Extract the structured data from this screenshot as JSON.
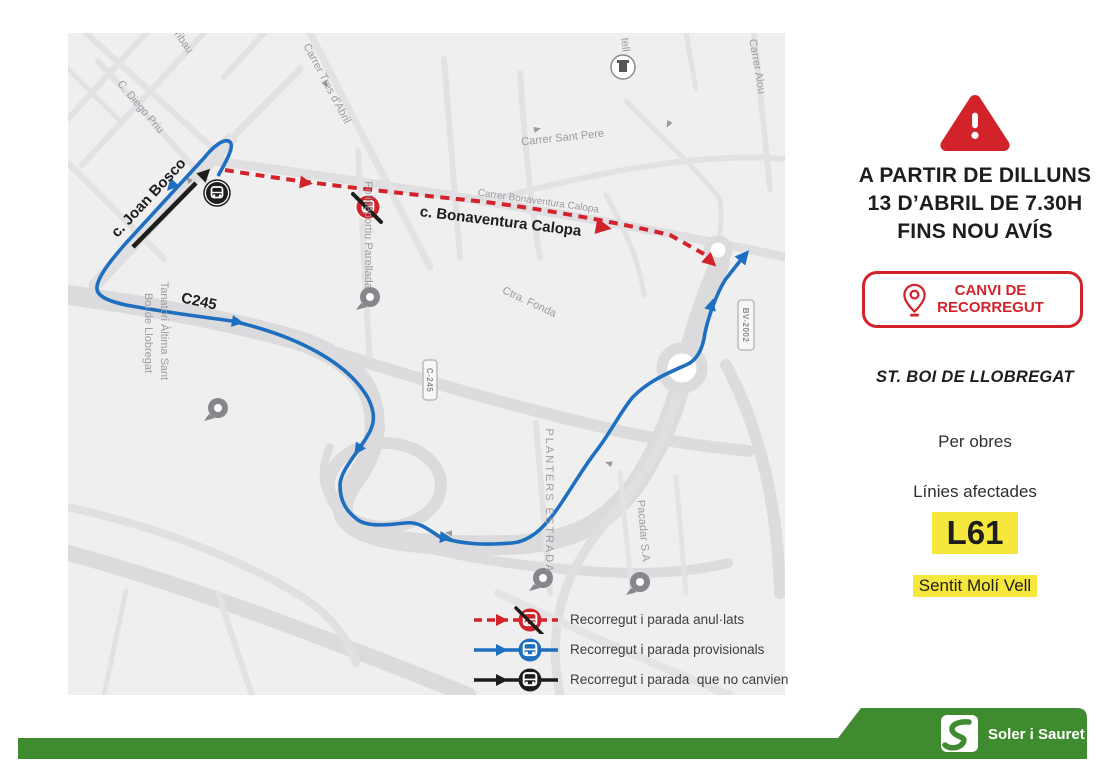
{
  "poster": {
    "alert": {
      "title_lines": [
        "A PARTIR DE DILLUNS",
        "13 D’ABRIL DE 7.30H",
        "FINS NOU AVÍS"
      ],
      "badge": {
        "line1": "CANVI DE",
        "line2": "RECORREGUT"
      },
      "location": "ST. BOI DE LLOBREGAT",
      "reason": "Per obres",
      "affected_label": "Línies afectades",
      "line_code": "L61",
      "direction": "Sentit Molí Vell"
    },
    "legend": {
      "items": [
        {
          "id": "cancelled",
          "label": "Recorregut i parada anul·lats",
          "color": "#d2232a"
        },
        {
          "id": "provisional",
          "label": "Recorregut i parada provisionals",
          "color": "#1e6fbf"
        },
        {
          "id": "unchanged",
          "label": "Recorregut i parada  que no canvien",
          "color": "#1d1d1b"
        }
      ]
    },
    "map": {
      "route_annotations": {
        "joan_bosco": "c. Joan Bosco",
        "bonaventura_calopa": "c. Bonaventura Calopa",
        "c245": "C245"
      },
      "street_labels": {
        "aribau": "ribau",
        "tres_dabril": "Carrer Tres d'Abril",
        "diego_priu": "C. Diego Priu",
        "polideportiu": "Polideportiu Parellada",
        "bonaventura_gray": "Carrer Bonaventura Calopa",
        "sant_pere": "Carrer Sant Pere",
        "castell": "tell",
        "carrer_alou": "Carrer Alou",
        "tanatori_line1": "Tanatori Àltima Sant",
        "tanatori_line2": "Boi de Llobregat",
        "ctra_fonda": "Ctra. Fonda",
        "planters": "PLANTERS ESTRADA",
        "pacadar": "Pacadar S.A"
      },
      "road_shields": {
        "c245": "C-245",
        "bv2002": "BV-2002"
      }
    },
    "footer": {
      "brand": "Soler i Sauret"
    },
    "colors": {
      "accent_red": "#d2232a",
      "route_blue": "#1e6fbf",
      "route_black": "#1d1d1b",
      "highlight_yellow": "#f6e73c",
      "brand_green": "#3f8b2f"
    }
  }
}
